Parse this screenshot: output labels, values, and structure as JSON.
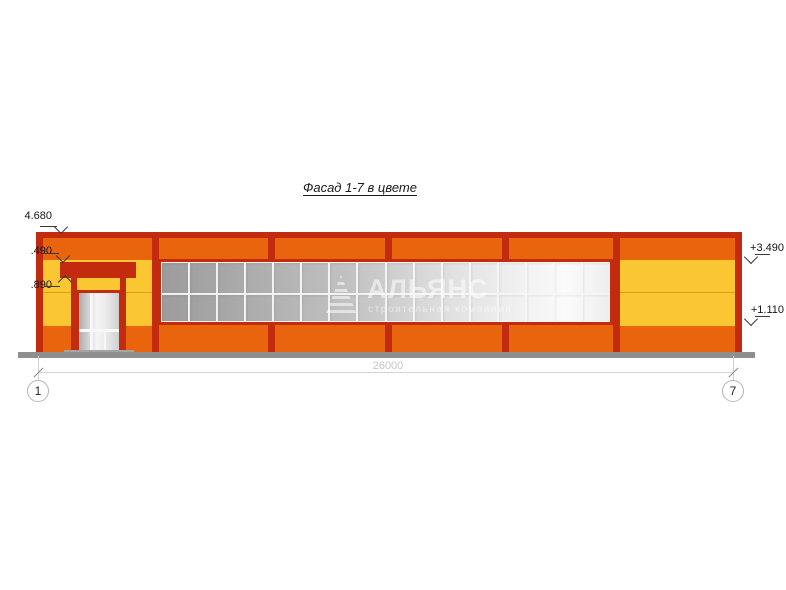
{
  "title": "Фасад 1-7 в цвете",
  "drawing": {
    "dimension_label": "26000",
    "axis_left": "1",
    "axis_right": "7",
    "elevations_left": [
      {
        "text": "4.680"
      },
      {
        "text": ".490"
      },
      {
        "text": ".890"
      }
    ],
    "elevations_right": [
      {
        "text": "+3.490"
      },
      {
        "text": "+1.110"
      }
    ]
  },
  "watermark": {
    "name": "АЛЬЯНС",
    "subtitle": "строительная компания"
  },
  "facade": {
    "window_columns": 16,
    "window_rows": 2,
    "colors": {
      "dark_red": "#c32b0e",
      "orange": "#e8650e",
      "yellow": "#fac733",
      "glass_dark": "#9c9c9c",
      "glass_light": "#fafafa",
      "ground": "#8f8f8f"
    }
  }
}
